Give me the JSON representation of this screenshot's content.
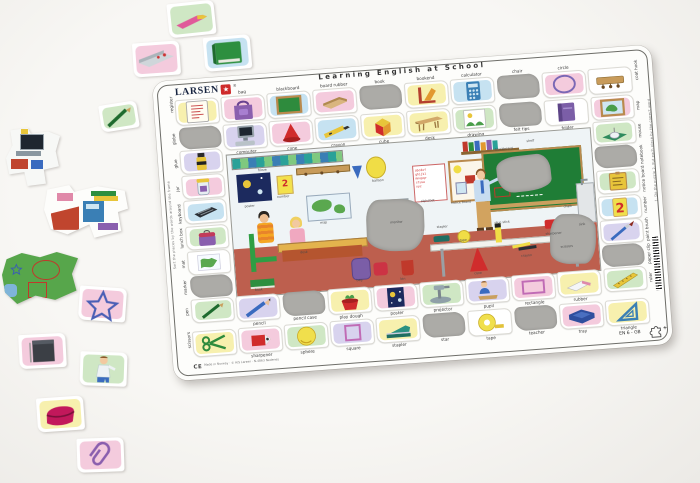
{
  "title": "Learning English at School",
  "brand": {
    "name": "LARSEN",
    "star": "★",
    "registered": "®",
    "code": "EN 6 - GB",
    "plus": "+"
  },
  "palette": {
    "pink": "#f4cbdd",
    "blue": "#c6e2f1",
    "yellow": "#f7f0ae",
    "green": "#cfe7c4",
    "lavender": "#d8d3ee",
    "white": "#ffffff",
    "slot_gray": "#acaba7",
    "board_white": "#fdfdfb",
    "accent_red": "#ce2b2b"
  },
  "board": {
    "top_outer": [
      {
        "word": "register",
        "icon": "register",
        "bg": "yellow",
        "corner": true
      },
      {
        "word": "bag",
        "icon": "bag",
        "bg": "pink"
      },
      {
        "word": "blackboard",
        "icon": "blackboard",
        "bg": "blue"
      },
      {
        "word": "board rubber",
        "icon": "board-rubber",
        "bg": "pink"
      },
      {
        "word": "book",
        "missing": true
      },
      {
        "word": "bookend",
        "icon": "bookend",
        "bg": "yellow"
      },
      {
        "word": "calculator",
        "icon": "calculator",
        "bg": "blue"
      },
      {
        "word": "chair",
        "missing": true
      },
      {
        "word": "circle",
        "icon": "circle",
        "bg": "pink"
      },
      {
        "word": "coat hook",
        "icon": "coat-hook",
        "bg": "white",
        "corner": true
      }
    ],
    "top_inner": [
      {
        "word": "computer",
        "icon": "computer",
        "bg": "lavender"
      },
      {
        "word": "cone",
        "icon": "cone",
        "bg": "pink"
      },
      {
        "word": "crayon",
        "icon": "crayon",
        "bg": "blue"
      },
      {
        "word": "cube",
        "icon": "cube",
        "bg": "yellow"
      },
      {
        "word": "desk",
        "icon": "desk",
        "bg": "yellow"
      },
      {
        "word": "drawing",
        "icon": "drawing",
        "bg": "green"
      },
      {
        "word": "felt tips",
        "missing": true
      },
      {
        "word": "folder",
        "icon": "folder",
        "bg": "white"
      }
    ],
    "left_col": [
      {
        "word": "globe",
        "missing": true
      },
      {
        "word": "glue",
        "icon": "glue",
        "bg": "lavender"
      },
      {
        "word": "jar",
        "icon": "jar",
        "bg": "pink"
      },
      {
        "word": "keyboard",
        "icon": "keyboard",
        "bg": "blue"
      },
      {
        "word": "lunch box",
        "icon": "lunch-box",
        "bg": "green"
      },
      {
        "word": "mat",
        "icon": "mat",
        "bg": "white"
      },
      {
        "word": "marker",
        "missing": true
      },
      {
        "word": "pen",
        "icon": "pen",
        "bg": "green"
      }
    ],
    "right_col": [
      {
        "word": "map",
        "icon": "map",
        "bg": "pink"
      },
      {
        "word": "mouse",
        "icon": "mouse",
        "bg": "green"
      },
      {
        "word": "notebook",
        "missing": true
      },
      {
        "word": "notice board",
        "icon": "notice-board",
        "bg": "green"
      },
      {
        "word": "number",
        "icon": "number",
        "bg": "blue"
      },
      {
        "word": "paint brush",
        "icon": "paint-brush",
        "bg": "lavender"
      },
      {
        "word": "paper clip",
        "missing": true
      },
      {
        "word": "ruler",
        "icon": "ruler",
        "bg": "green"
      }
    ],
    "bottom_inner": [
      {
        "word": "pencil",
        "icon": "pencil",
        "bg": "lavender"
      },
      {
        "word": "pencil case",
        "missing": true
      },
      {
        "word": "play dough",
        "icon": "play-dough",
        "bg": "yellow"
      },
      {
        "word": "poster",
        "icon": "poster",
        "bg": "pink"
      },
      {
        "word": "projector",
        "icon": "projector",
        "bg": "green"
      },
      {
        "word": "pupil",
        "icon": "pupil",
        "bg": "lavender"
      },
      {
        "word": "rectangle",
        "icon": "rectangle",
        "bg": "pink"
      },
      {
        "word": "rubber",
        "icon": "rubber",
        "bg": "yellow"
      }
    ],
    "bottom_outer": [
      {
        "word": "scissors",
        "icon": "scissors",
        "bg": "yellow",
        "corner": true
      },
      {
        "word": "sharpener",
        "icon": "sharpener",
        "bg": "pink"
      },
      {
        "word": "sphere",
        "icon": "sphere",
        "bg": "green"
      },
      {
        "word": "square",
        "icon": "square",
        "bg": "lavender"
      },
      {
        "word": "stapler",
        "icon": "stapler",
        "bg": "yellow"
      },
      {
        "word": "star",
        "missing": true
      },
      {
        "word": "tape",
        "icon": "tape",
        "bg": "white"
      },
      {
        "word": "teacher",
        "missing": true
      },
      {
        "word": "tray",
        "icon": "tray",
        "bg": "pink"
      },
      {
        "word": "triangle",
        "icon": "triangle-tool",
        "bg": "yellow"
      }
    ]
  },
  "corner_labels": {
    "top_left": "register",
    "top_right": "coat hook",
    "bottom_left": "scissors",
    "bottom_right": "triangle"
  },
  "edge_instructions": {
    "left": "Sort the pieces by the words around the frame",
    "right": "1. Do the puzzle  2. Put each piece by the correct word"
  },
  "scene": {
    "number_card": "2",
    "alphabet": "abcdef\nghijkl\nmnopqr\nstuvw\nxyz",
    "labels": [
      {
        "t": "frieze",
        "x": 30,
        "y": 15
      },
      {
        "t": "poster",
        "x": 14,
        "y": 50
      },
      {
        "t": "number",
        "x": 47,
        "y": 43
      },
      {
        "t": "balloon",
        "x": 143,
        "y": 34
      },
      {
        "t": "alphabet",
        "x": 190,
        "y": 58
      },
      {
        "t": "map",
        "x": 88,
        "y": 72
      },
      {
        "t": "monitor",
        "x": 158,
        "y": 77
      },
      {
        "t": "shelf",
        "x": 300,
        "y": 6
      },
      {
        "t": "notice board",
        "x": 220,
        "y": 62
      },
      {
        "t": "blackboard",
        "x": 268,
        "y": 12
      },
      {
        "t": "chalk",
        "x": 332,
        "y": 74
      },
      {
        "t": "sink",
        "x": 346,
        "y": 93
      },
      {
        "t": "stapler",
        "x": 204,
        "y": 85
      },
      {
        "t": "glue stick",
        "x": 262,
        "y": 85
      },
      {
        "t": "sharpener",
        "x": 312,
        "y": 100
      },
      {
        "t": "tape",
        "x": 226,
        "y": 100
      },
      {
        "t": "crayon",
        "x": 286,
        "y": 120
      },
      {
        "t": "scissors",
        "x": 326,
        "y": 114
      },
      {
        "t": "cone",
        "x": 238,
        "y": 134
      },
      {
        "t": "bin",
        "x": 164,
        "y": 134
      },
      {
        "t": "book",
        "x": 18,
        "y": 134
      },
      {
        "t": "bag",
        "x": 120,
        "y": 132
      },
      {
        "t": "desk",
        "x": 66,
        "y": 100
      }
    ]
  },
  "pieces": [
    {
      "kind": "tile",
      "icon": "felt-tip",
      "bg": "green",
      "x": 168,
      "y": 2,
      "r": -6
    },
    {
      "kind": "tile",
      "icon": "pencil-tin",
      "bg": "pink",
      "x": 133,
      "y": 42,
      "r": -4
    },
    {
      "kind": "tile",
      "icon": "book",
      "bg": "blue",
      "x": 204,
      "y": 36,
      "r": -5
    },
    {
      "kind": "tile",
      "icon": "pen",
      "bg": "green",
      "x": 100,
      "y": 103,
      "r": -9,
      "small": true
    },
    {
      "kind": "scene",
      "icon": "scene-computer",
      "x": 6,
      "y": 128
    },
    {
      "kind": "scene",
      "icon": "scene-desk",
      "x": 44,
      "y": 184
    },
    {
      "kind": "scene",
      "icon": "scene-mat",
      "x": 2,
      "y": 252
    },
    {
      "kind": "tile",
      "icon": "star",
      "bg": "pink",
      "x": 79,
      "y": 287,
      "r": 4
    },
    {
      "kind": "tile",
      "icon": "notebook",
      "bg": "pink",
      "x": 19,
      "y": 334,
      "r": -3
    },
    {
      "kind": "tile",
      "icon": "teacher",
      "bg": "green",
      "x": 80,
      "y": 352,
      "r": 2
    },
    {
      "kind": "tile",
      "icon": "pencil-case",
      "bg": "yellow",
      "x": 37,
      "y": 397,
      "r": -4
    },
    {
      "kind": "tile",
      "icon": "paper-clip",
      "bg": "pink",
      "x": 77,
      "y": 438,
      "r": -2
    }
  ],
  "footer": {
    "ce": "CE",
    "imprint": "Made in Norway · © A/S Larsen · N-4863 Nedenes"
  }
}
